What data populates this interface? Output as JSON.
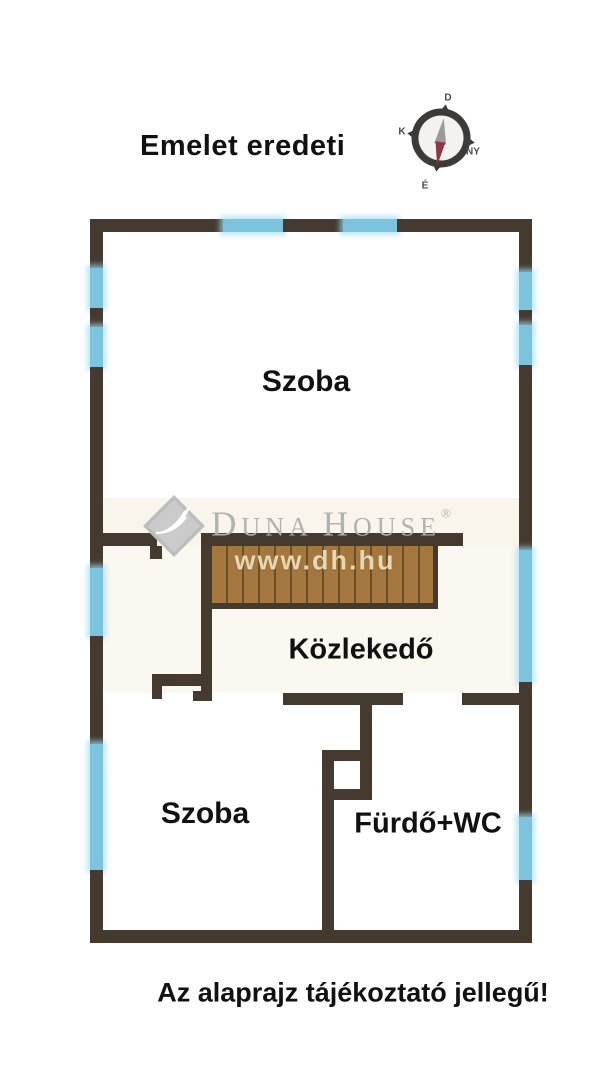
{
  "title": "Emelet eredeti",
  "footer_note": "Az alaprajz tájékoztató jellegű!",
  "compass": {
    "north": "É",
    "south": "D",
    "east": "K",
    "west": "NY"
  },
  "rooms": {
    "upper": "Szoba",
    "corridor": "Közlekedő",
    "lower": "Szoba",
    "bath": "Fürdő+WC"
  },
  "watermark": {
    "brand_d": "D",
    "brand_una": "UNA",
    "brand_h": "H",
    "brand_ouse": "OUSE",
    "registered": "®",
    "website": "www.dh.hu"
  },
  "colors": {
    "wall": "#453a2f",
    "window": "#7cc4de",
    "stairs": "#a3773e",
    "stair_tread": "#6b5027",
    "watermark": "#b2b2b2",
    "website_text": "#e8d7b2",
    "ink": "#111111",
    "cream": "#f6eddc"
  }
}
